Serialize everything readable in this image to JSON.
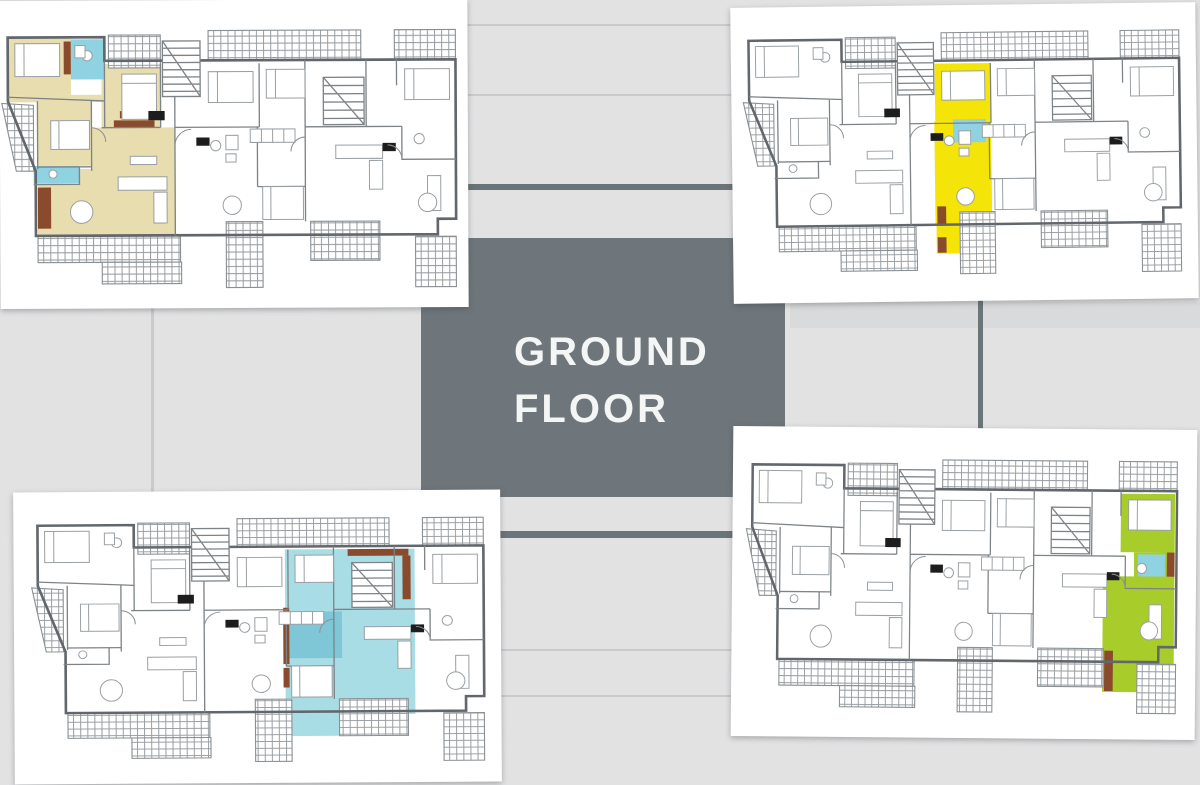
{
  "slide": {
    "title_line1": "GROUND",
    "title_line2": "FLOOR"
  },
  "colors": {
    "slate": "#6e767b",
    "tile": "#e2e2e3",
    "tile_shade": "#d9dadb",
    "seam_light": "#c9cacb",
    "seam_dark": "#6b7478",
    "panel": "#ffffff",
    "wall": "#61676c",
    "inner_wall": "#7d8387",
    "furniture_line": "#9aa0a4",
    "hatch_line": "#9a9fa3",
    "marker_black": "#1d1d1d",
    "door_arc": "#8a9094",
    "beige": "#e8ddae",
    "yellow": "#f5e407",
    "cyan": "#a9dde6",
    "cyan_dark": "#7fc6d6",
    "green": "#a8cd2b",
    "bath_blue": "#8fd2e2",
    "brown": "#8a4a2c"
  },
  "panels": [
    {
      "name": "top-left",
      "highlight": "beige-unit",
      "highlight_color": "#e8ddae"
    },
    {
      "name": "top-right",
      "highlight": "yellow-unit",
      "highlight_color": "#f5e407"
    },
    {
      "name": "bottom-left",
      "highlight": "cyan-unit",
      "highlight_color": "#a9dde6"
    },
    {
      "name": "bottom-right",
      "highlight": "green-unit",
      "highlight_color": "#a8cd2b"
    }
  ]
}
